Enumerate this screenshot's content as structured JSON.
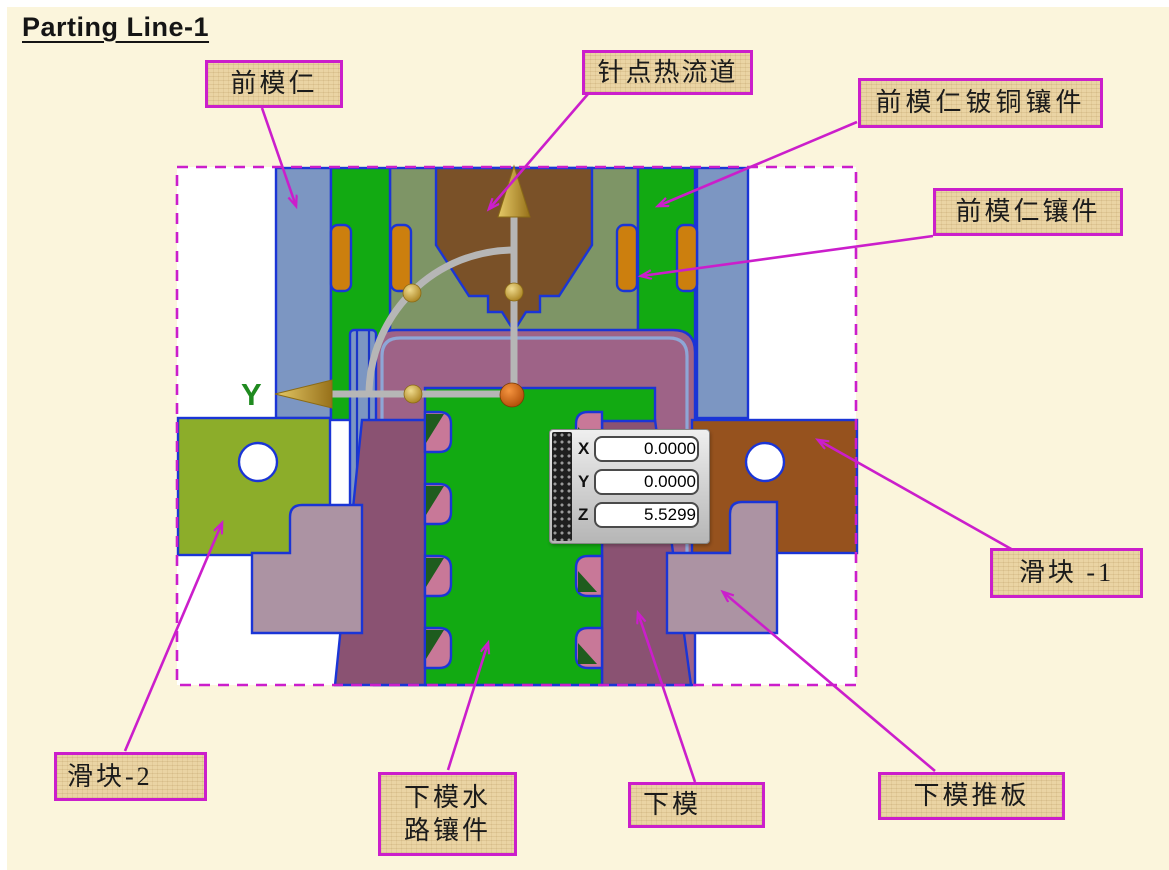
{
  "page": {
    "title": "Parting Line-1"
  },
  "viewport": {
    "axis_label_y": "Y"
  },
  "callouts": [
    {
      "id": "front-mold-core",
      "text": "前模仁"
    },
    {
      "id": "pinpoint-hot-runner",
      "text": "针点热流道"
    },
    {
      "id": "front-core-becu-insert",
      "text": "前模仁铍铜镶件"
    },
    {
      "id": "front-core-insert",
      "text": "前模仁镶件"
    },
    {
      "id": "slider-1",
      "text": "滑块 -1"
    },
    {
      "id": "slider-2",
      "text": "滑块-2"
    },
    {
      "id": "lower-mold-water-insert",
      "text": "下模水路镶件"
    },
    {
      "id": "lower-mold",
      "text": "下模"
    },
    {
      "id": "lower-mold-ejector-plate",
      "text": "下模推板"
    }
  ],
  "coordinate_panel": {
    "rows": [
      {
        "axis": "X",
        "value": "0.0000"
      },
      {
        "axis": "Y",
        "value": "0.0000"
      },
      {
        "axis": "Z",
        "value": "5.5299"
      }
    ]
  },
  "colors": {
    "page_bg": "#FBF5DC",
    "magenta": "#CB1ECB",
    "outline_blue": "#1A35D6",
    "steel_blue": "#7C96C2",
    "bright_green": "#12AA12",
    "sage_green": "#7E9566",
    "nozzle_brown": "#7A5128",
    "slider_brown": "#96521E",
    "mold_purple": "#9E6387",
    "mold_dark_purple": "#8A5272",
    "slider_olive": "#8CAD2A",
    "ejector_mauve": "#AC93A3",
    "cooling_pink": "#C87898",
    "oring_orange": "#CC7F0E",
    "label_bg": "#EAD4A4"
  }
}
